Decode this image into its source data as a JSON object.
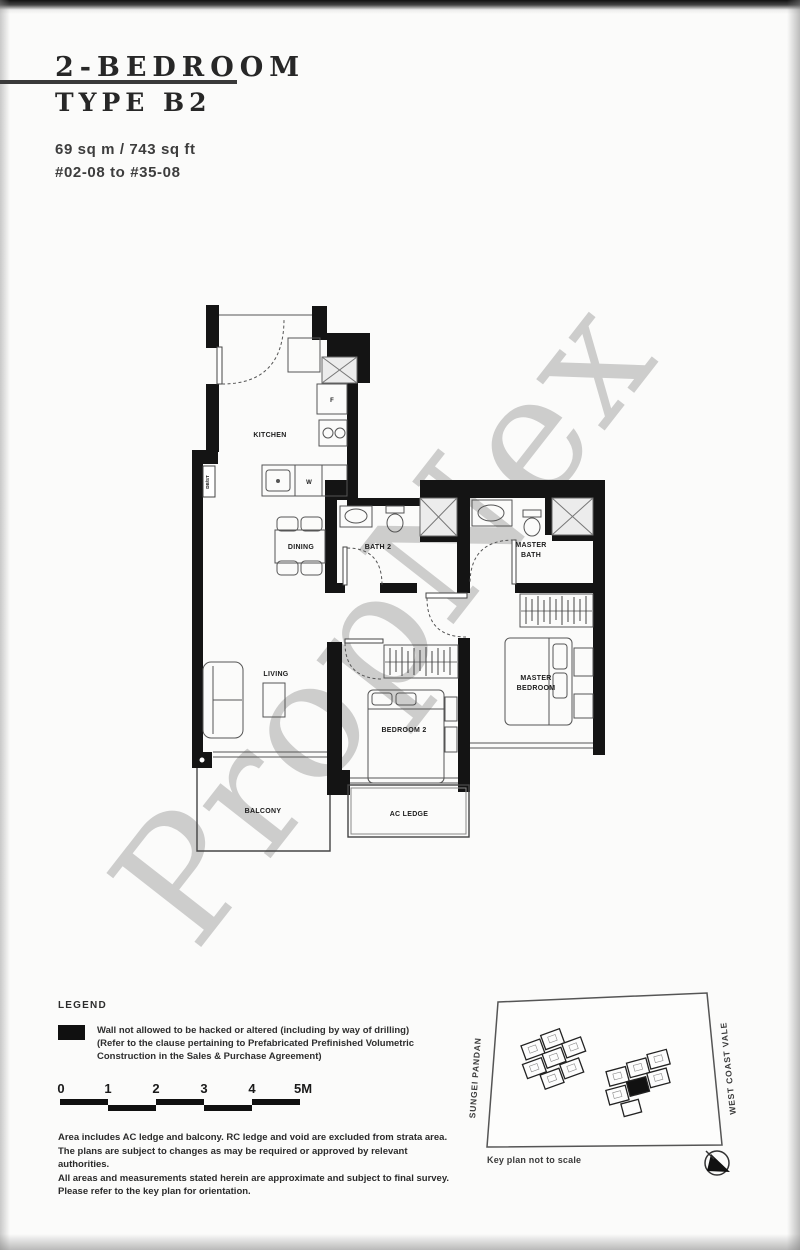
{
  "header": {
    "title_line1": "2-BEDROOM",
    "title_line2": "TYPE B2",
    "area": "69 sq m / 743 sq ft",
    "stack": "#02-08 to #35-08"
  },
  "watermark": "PropNex",
  "floorplan": {
    "kitchen": "KITCHEN",
    "dining": "DINING",
    "bath2": "BATH 2",
    "master_bath": [
      "MASTER",
      "BATH"
    ],
    "living": "LIVING",
    "bedroom2": "BEDROOM 2",
    "master_bedroom": [
      "MASTER",
      "BEDROOM"
    ],
    "balcony": "BALCONY",
    "ac_ledge": "AC LEDGE",
    "fridge": "F",
    "washer": "W",
    "db_st": "DB/ST"
  },
  "legend": {
    "heading": "LEGEND",
    "lines": [
      "Wall not allowed to be hacked or altered (including by way of drilling)",
      "(Refer to the clause pertaining to Prefabricated Prefinished Volumetric",
      "Construction in the Sales & Purchase Agreement)"
    ]
  },
  "scale_bar": {
    "labels": [
      "0",
      "1",
      "2",
      "3",
      "4",
      "5M"
    ]
  },
  "disclaimer": {
    "lines": [
      "Area includes AC ledge and balcony. RC ledge and void are excluded from strata area.",
      "The plans are subject to changes as may be required or approved by relevant authorities.",
      "All areas and measurements stated herein are approximate and subject to final survey.",
      "Please refer to the key plan for orientation."
    ]
  },
  "key_plan": {
    "left_road": "SUNGEI PANDAN",
    "right_road": "WEST COAST VALE",
    "note": "Key plan not to scale"
  }
}
